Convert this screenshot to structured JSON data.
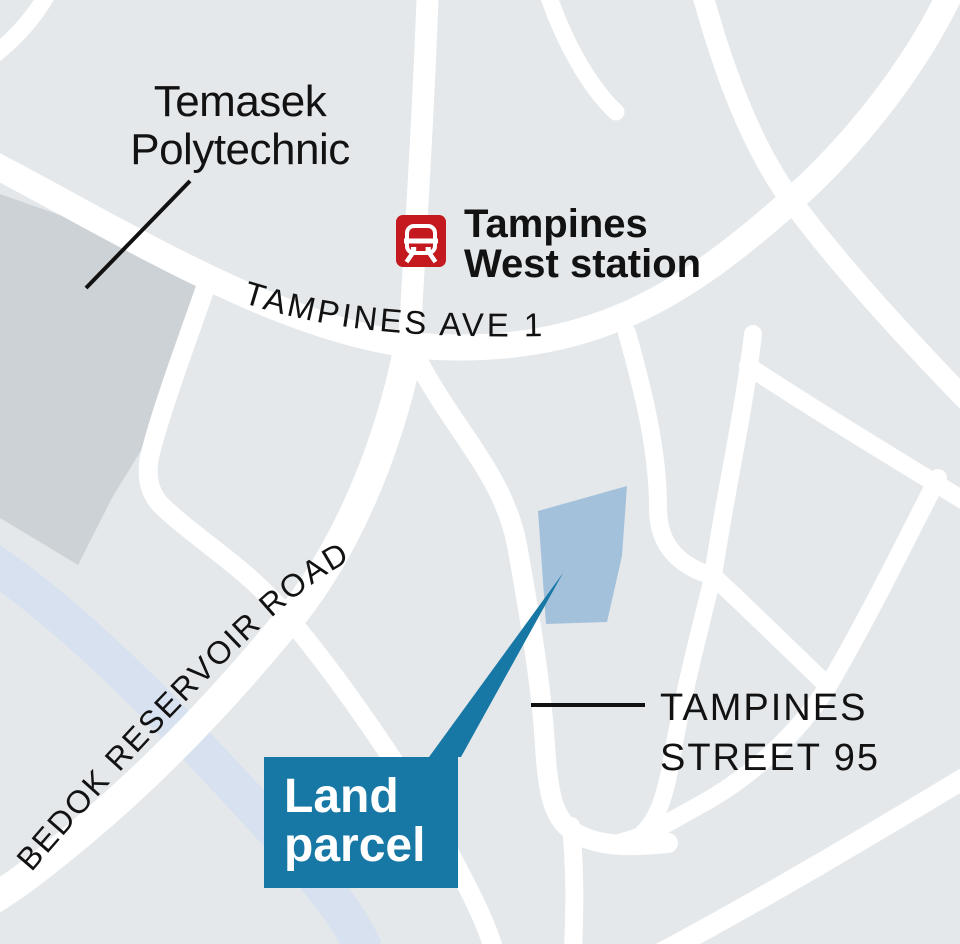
{
  "map": {
    "title": "Tampines land parcel locator map",
    "colors": {
      "background": "#e4e8eb",
      "road": "#ffffff",
      "campus": "#cdd2d7",
      "water": "#d7e1f0",
      "parcel": "#a4c1dc",
      "callout": "#1878a5",
      "callout_text": "#ffffff",
      "station_red": "#c3191f",
      "text": "#121212",
      "leader": "#111111"
    },
    "labels": {
      "campus": {
        "line1": "Temasek",
        "line2": "Polytechnic"
      },
      "station": {
        "line1": "Tampines",
        "line2": "West station"
      },
      "ave1": "TAMPINES AVE 1",
      "bedok": "BEDOK RESERVOIR ROAD",
      "street95": {
        "line1": "TAMPINES",
        "line2": "STREET 95"
      },
      "callout": {
        "line1": "Land",
        "line2": "parcel"
      }
    },
    "icons": {
      "station": "mrt-train-icon"
    }
  }
}
